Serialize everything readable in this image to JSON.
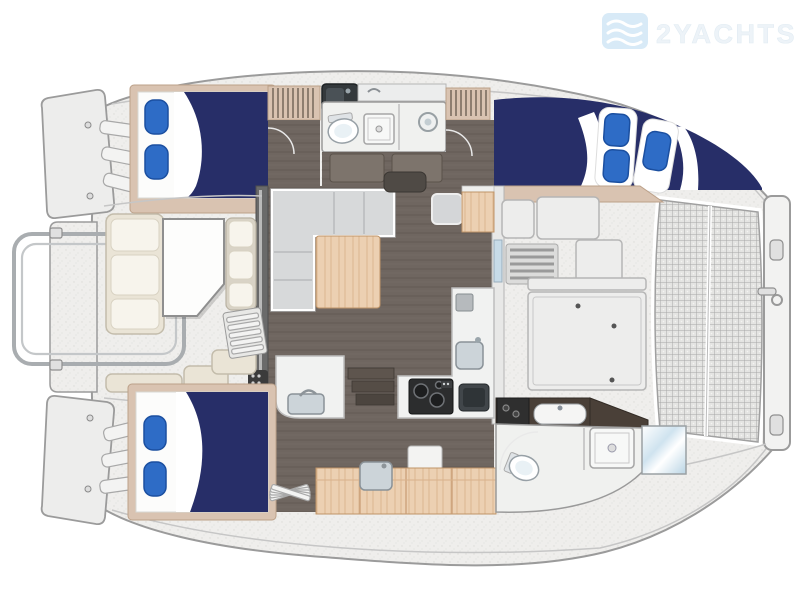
{
  "watermark": {
    "brand": "2YACHTS"
  },
  "diagram": {
    "type": "yacht-floor-plan",
    "vessel": "sailing-catamaran-top-view",
    "features": [
      "port-aft-cabin-double-berth",
      "port-forward-head-with-shower",
      "starboard-forward-cabin-double-berth",
      "starboard-aft-cabin-double-berth",
      "salon-l-shaped-sofa",
      "salon-wood-table",
      "galley-with-stove-and-sinks",
      "aft-cockpit-seating-and-table",
      "forward-cockpit-benches-and-hatches",
      "bow-trampoline-net",
      "forward-crossbeam",
      "transom-steps",
      "stern-davit-rail",
      "starboard-aft-head-with-shower",
      "hanging-lockers",
      "companionway-steps"
    ]
  },
  "colors": {
    "navy": "#272e68",
    "pillowBlue": "#2e6cc6",
    "pillowEdge": "#1b4fa0",
    "tan": "#d9c3b1",
    "tanEdge": "#bca189",
    "wood": "#ecd0b2",
    "woodEdge": "#bf9468",
    "woodLine": "#d9b38c",
    "floorBrown": "#6f6660",
    "floorLine": "#665d57",
    "deck": "#efeeec",
    "deckEdge": "#9b9b9b",
    "deckLine": "#c6c6c6",
    "cream": "#eae4d6",
    "creamEdge": "#c3bcab",
    "creamHi": "#f7f4ec",
    "sofaGray": "#d7d9da",
    "counter": "#f1f2f1",
    "bath": "#f0f1ef",
    "dark": "#4a4038",
    "stove": "#2c2d2e",
    "glassBlue": "#c7dbe8",
    "sinkBlue": "#ccd4d9",
    "meshBg": "#e4e4e2",
    "meshLine": "#a8a8a8",
    "slider": "#6a6a6a",
    "logoBlue": "#d8eaf7",
    "wmText": "#edf3f8"
  }
}
